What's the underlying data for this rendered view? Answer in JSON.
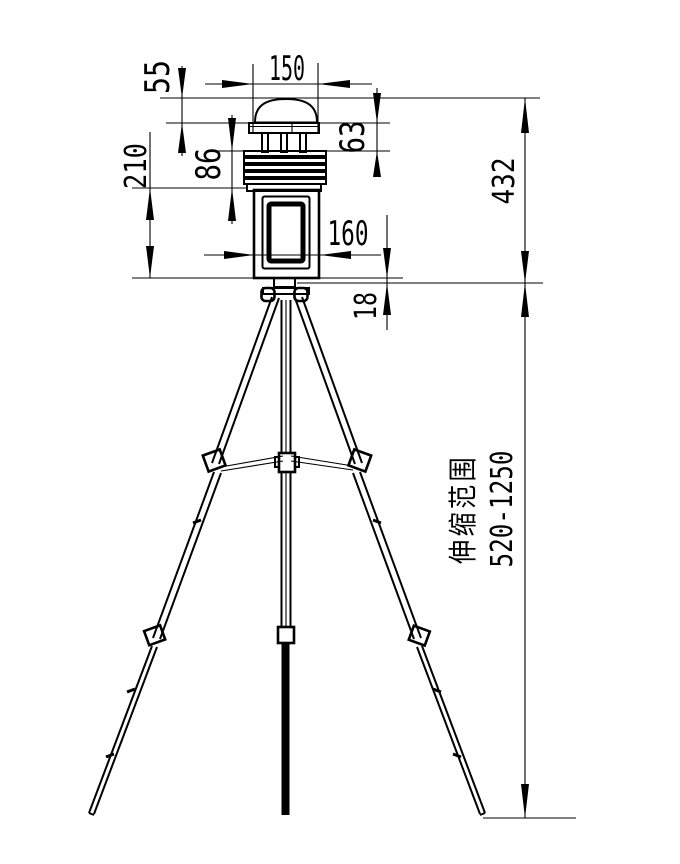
{
  "drawing": {
    "type": "technical-dimension-drawing",
    "subject": "weather-station-on-telescopic-tripod",
    "colors": {
      "background": "#ffffff",
      "line": "#000000"
    },
    "dimensions": {
      "cap_width": "150",
      "dome_height": "55",
      "head_section_height": "63",
      "shield_section_height": "86",
      "body_height": "210",
      "body_width": "160",
      "adapter_height": "18",
      "station_total_height": "432",
      "telescope_label": "伸缩范围",
      "telescope_range": "520-1250"
    }
  }
}
